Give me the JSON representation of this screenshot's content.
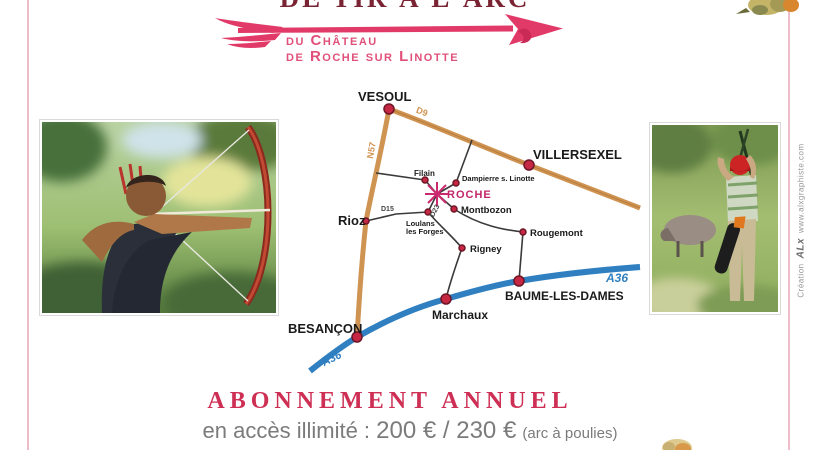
{
  "header": {
    "title": "DE TIR À L'ARC",
    "subtitle_line1": "du Château",
    "subtitle_line2": "de Roche sur Linotte"
  },
  "map": {
    "roads": {
      "n57": "N57",
      "d9": "D9",
      "d15": "D15",
      "d23": "D23",
      "a36": "A36"
    },
    "towns": {
      "vesoul": "VESOUL",
      "villersexel": "VILLERSEXEL",
      "rioz": "Rioz",
      "besancon": "BESANÇON",
      "marchaux": "Marchaux",
      "baume_les_dames": "BAUME-LES-DAMES",
      "filain": "Filain",
      "dampierre": "Dampierre s. Linotte",
      "montbozon": "Montbozon",
      "loulans_line1": "Loulans",
      "loulans_line2": "les Forges",
      "rigney": "Rigney",
      "rougemont": "Rougemont"
    },
    "site_label": "ROCHE"
  },
  "pricing": {
    "heading": "ABONNEMENT ANNUEL",
    "prefix": "en accès illimité :",
    "price": "200 € / 230 €",
    "note": "(arc à poulies)"
  },
  "credit": {
    "prefix": "Création",
    "logo": "ALx",
    "site": "www.alxgraphiste.com"
  },
  "colors": {
    "accent_pink": "#e23a68",
    "title_maroon": "#7a2433",
    "road_orange": "#cf9352",
    "highway_blue": "#2f7fc1",
    "marker_red": "#c62844",
    "heading_crimson": "#ce2f55",
    "body_gray": "#7b7b7b"
  }
}
